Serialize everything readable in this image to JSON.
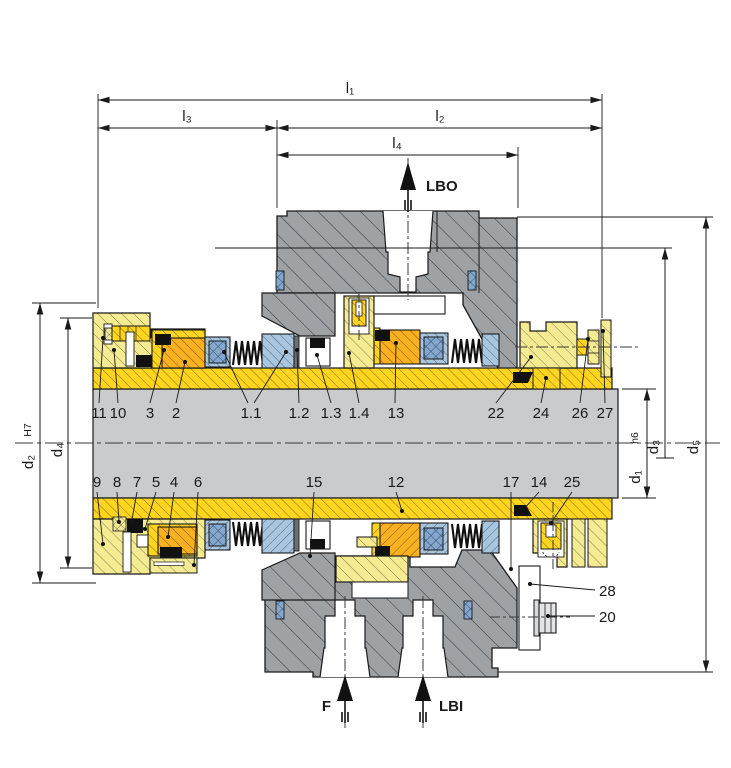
{
  "drawing": {
    "dim_labels": {
      "l1": "l₁",
      "l3": "l₃",
      "l2": "l₂",
      "l4": "l₄",
      "d2": "d₂",
      "d2_tol": "H7",
      "d4": "d₄",
      "d1": "d₁",
      "d1_tol": "h6",
      "d3": "d₃",
      "d5": "d₅"
    },
    "flow_labels": {
      "lbo": "LBO",
      "f": "F",
      "lbi": "LBI"
    },
    "part_labels": {
      "p11": "11",
      "p10": "10",
      "p3": "3",
      "p2": "2",
      "p1_1": "1.1",
      "p1_2": "1.2",
      "p1_3": "1.3",
      "p1_4": "1.4",
      "p13": "13",
      "p22": "22",
      "p24": "24",
      "p26": "26",
      "p27": "27",
      "p9": "9",
      "p8": "8",
      "p7": "7",
      "p5": "5",
      "p4": "4",
      "p6": "6",
      "p15": "15",
      "p12": "12",
      "p17": "17",
      "p14": "14",
      "p25": "25",
      "p28": "28",
      "p20": "20"
    },
    "colors": {
      "housing_gray": "#9FA2A5",
      "shaft_gray": "#C9CBCC",
      "component_yellow": "#F5EB92",
      "sleeve_yellow": "#FFD520",
      "seal_orange": "#F9B021",
      "ring_blue": "#A9C6DE",
      "oring_blue": "#85A7CC",
      "line_black": "#1a1a1a",
      "background": "#FFFFFF"
    }
  }
}
